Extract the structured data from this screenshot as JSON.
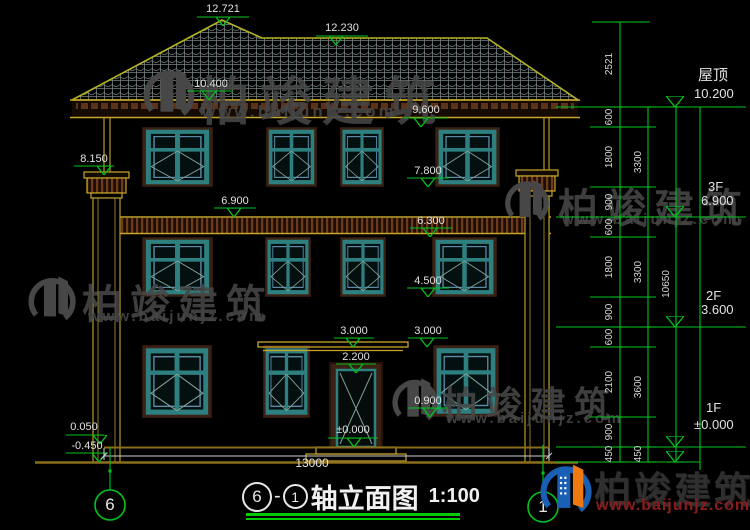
{
  "title": {
    "bubble_start": "6",
    "dash": "-",
    "bubble_end": "1",
    "text": "轴立面图",
    "scale": "1:100"
  },
  "axis": {
    "left": "6",
    "right": "1"
  },
  "bottom_dim": "13000",
  "marks": {
    "peak": "12.721",
    "ridge": "12.230",
    "eave_top": "10.400",
    "eave_bottom": "9.600",
    "chimney": "8.150",
    "sill_3f": "7.800",
    "floor_3f": "6.900",
    "band_bottom": "6.300",
    "sill_2f": "4.500",
    "canopy_left": "3.000",
    "canopy_right": "3.000",
    "door_top": "2.200",
    "sill_1f": "0.900",
    "zero": "±0.000",
    "plinth": "0.050",
    "ground": "-0.450"
  },
  "right_dims": {
    "col1": [
      "2521",
      "600",
      "1800",
      "900",
      "600",
      "1800",
      "900",
      "600",
      "2100",
      "900",
      "450"
    ],
    "col2": [
      "3300",
      "3300",
      "3600",
      "450"
    ],
    "col3": [
      "10650"
    ],
    "levels": [
      {
        "label": "屋顶",
        "value": "10.200"
      },
      {
        "label": "3F",
        "value": "6.900"
      },
      {
        "label": "2F",
        "value": "3.600"
      },
      {
        "label": "1F",
        "value": "±0.000"
      }
    ]
  },
  "watermark": {
    "name": "柏竣建筑",
    "url": "www.baijunjz.com"
  },
  "colors": {
    "dim_green": "#00c41e",
    "roof_outline": "#b5b520",
    "trim_yellow": "#c8a52a",
    "frame_brown": "#3a2113",
    "window_teal": "#2e7f7f",
    "logo_blue": "#1a5fb4",
    "logo_orange": "#f07810",
    "url_red": "#8b1c1c"
  }
}
